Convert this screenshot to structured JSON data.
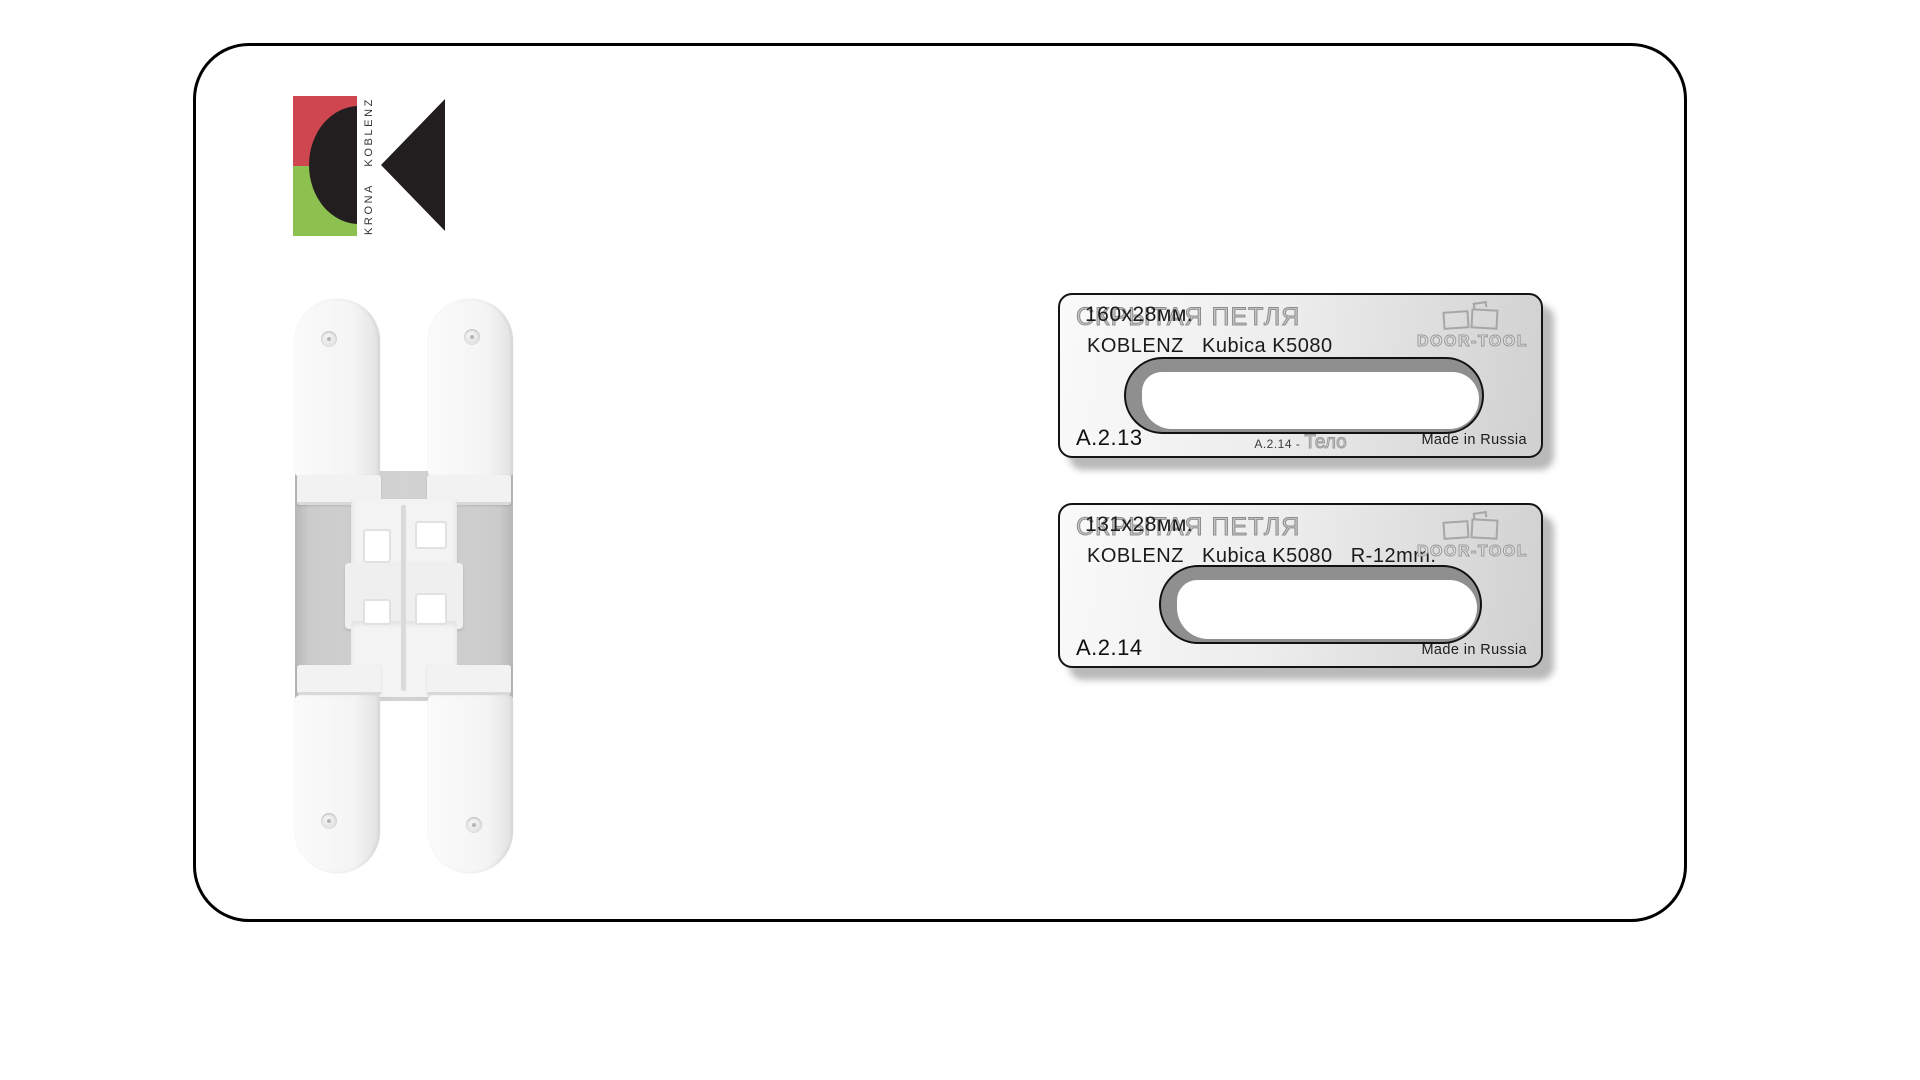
{
  "page": {
    "background": "#ffffff"
  },
  "logo": {
    "word_bottom": "KRONA",
    "word_top": "KOBLENZ",
    "red": "#ce4750",
    "green": "#8cc04f",
    "black": "#221d1e"
  },
  "plates": [
    {
      "title_engraved": "СКРЫТАЯ ПЕТЛЯ",
      "title_size": "160х28мм.",
      "subtitle": "KOBLENZ   Kubica K5080",
      "brand_logo_text": "DOOR-TOOL",
      "article": "A.2.13",
      "center_note_prefix": "A.2.14 -",
      "center_note_engraved": "Тело",
      "made_in": "Made in Russia"
    },
    {
      "title_engraved": "СКРЫТАЯ ПЕТЛЯ",
      "title_size": "131х28мм.",
      "subtitle": "KOBLENZ   Kubica K5080   R-12mm.",
      "brand_logo_text": "DOOR-TOOL",
      "article": "A.2.14",
      "made_in": "Made in Russia"
    }
  ]
}
